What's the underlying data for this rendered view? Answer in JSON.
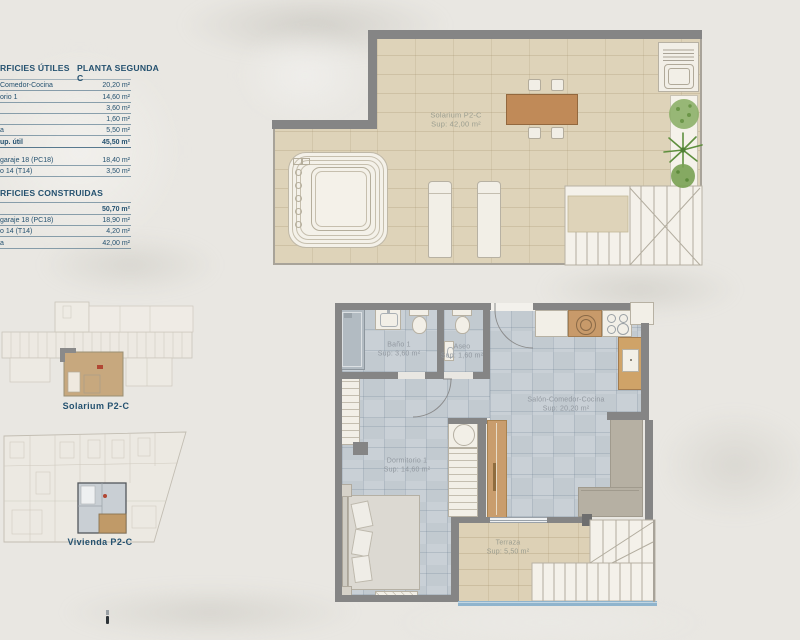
{
  "colors": {
    "background": "#e9e7e2",
    "accent_navy": "#24516f",
    "wall_gray": "#858585",
    "apartment_floor_tile": "#c9d0d6",
    "solarium_floor_brick": "#ded3b9",
    "terrace_floor_brick": "#ddd1b6",
    "wood_counter": "#c89a6a",
    "key_plan_highlight_tan": "#c7a87e",
    "pool_edge_blue": "#8fb4cd",
    "room_label_gray": "#9299a0"
  },
  "surface_table": {
    "header_left": "RFICIES ÚTILES",
    "header_right": "PLANTA SEGUNDA C",
    "utiles_rows": [
      {
        "label": "Comedor-Cocina",
        "value": "20,20 m²"
      },
      {
        "label": "orio 1",
        "value": "14,60 m²"
      },
      {
        "label": "",
        "value": "3,60 m²"
      },
      {
        "label": "",
        "value": "1,60 m²"
      },
      {
        "label": "a",
        "value": "5,50 m²"
      },
      {
        "label": "up. útil",
        "value": "45,50 m²"
      }
    ],
    "annex_rows": [
      {
        "label": "garaje 18 (PC18)",
        "value": "18,40 m²"
      },
      {
        "label": "o 14 (T14)",
        "value": "3,50 m²"
      }
    ],
    "construidas_header": "RFICIES CONSTRUIDAS",
    "construidas_rows": [
      {
        "label": "",
        "value": "50,70 m²"
      },
      {
        "label": "garaje 18 (PC18)",
        "value": "18,90 m²"
      },
      {
        "label": "o 14 (T14)",
        "value": "4,20 m²"
      },
      {
        "label": "a",
        "value": "42,00 m²"
      }
    ]
  },
  "solarium_plan": {
    "name": "Solarium P2-C",
    "area": "Sup: 42,00 m²"
  },
  "key_plans": {
    "solarium_label": "Solarium P2-C",
    "vivienda_label": "Vivienda P2-C"
  },
  "apartment_plan": {
    "rooms": [
      {
        "name": "Baño 1",
        "area": "Sup: 3,60 m²"
      },
      {
        "name": "Aseo",
        "area": "Sup: 1,60 m²"
      },
      {
        "name": "Salón-Comedor-Cocina",
        "area": "Sup: 20,20 m²"
      },
      {
        "name": "Dormitorio 1",
        "area": "Sup: 14,60 m²"
      },
      {
        "name": "Terraza",
        "area": "Sup: 5,50 m²"
      }
    ]
  }
}
